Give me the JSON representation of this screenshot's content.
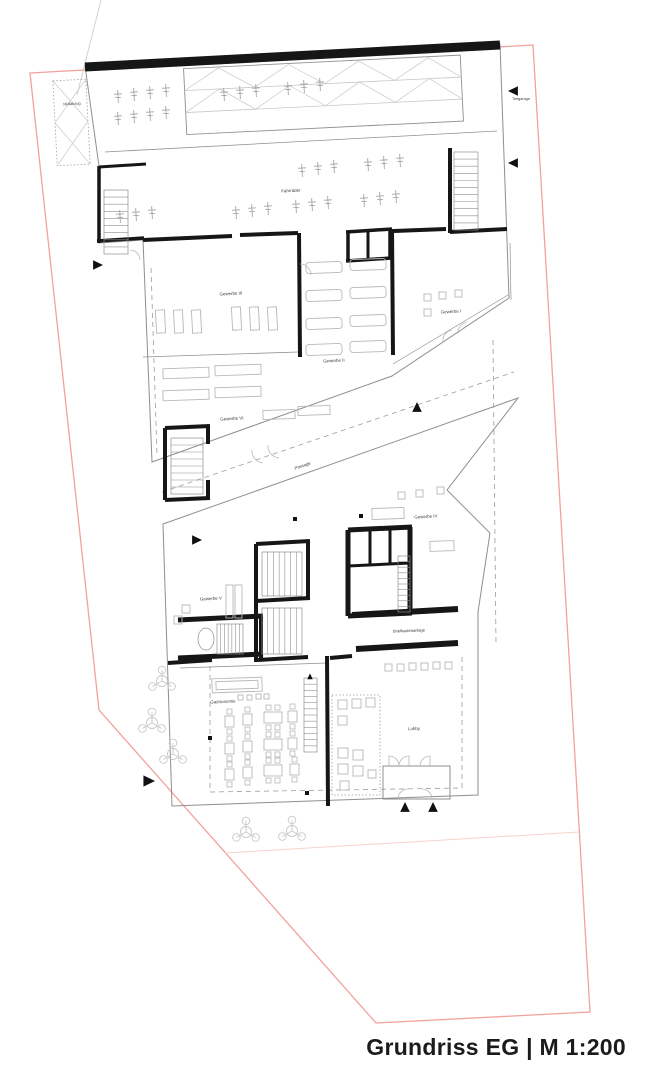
{
  "title": {
    "text": "Grundriss EG | M 1:200"
  },
  "colors": {
    "wall": "#161616",
    "thin": "#8f8f8f",
    "furniture": "#b8b8b8",
    "light": "#c8c8c8",
    "dash": "#9c9c9c",
    "label": "#3a3a3a",
    "boundary_red": "#f2a29b",
    "faint_red": "#f7d2ce",
    "construction": "#d2d2d2",
    "arrow": "#111111"
  },
  "site": {
    "boundary_points": "30,73 533,45 590,1012 376,1023 99,710",
    "faint_line": [
      225,
      853,
      579,
      832
    ],
    "construction_line": [
      101,
      0,
      77,
      95
    ]
  },
  "rooms": [
    {
      "id": "muellabzug",
      "label": "Müllabzug",
      "x": 72,
      "y": 105,
      "size": 3.8,
      "rot": -3
    },
    {
      "id": "tiefgarage",
      "label": "Tiefgarage",
      "x": 521,
      "y": 100,
      "size": 3.8,
      "rot": 0
    },
    {
      "id": "fahrraeder",
      "label": "Fahrräder",
      "x": 291,
      "y": 192,
      "size": 4.4,
      "rot": -3
    },
    {
      "id": "gewerbe-iii",
      "label": "Gewerbe III",
      "x": 231,
      "y": 295,
      "size": 4.4,
      "rot": -3
    },
    {
      "id": "gewerbe-i",
      "label": "Gewerbe I",
      "x": 451,
      "y": 313,
      "size": 4.4,
      "rot": -3
    },
    {
      "id": "gewerbe-ii",
      "label": "Gewerbe II",
      "x": 334,
      "y": 362,
      "size": 4.4,
      "rot": -3
    },
    {
      "id": "gewerbe-vi",
      "label": "Gewerbe VI",
      "x": 232,
      "y": 420,
      "size": 4.4,
      "rot": -3
    },
    {
      "id": "passage",
      "label": "Passage",
      "x": 303,
      "y": 467,
      "size": 4.3,
      "rot": -19
    },
    {
      "id": "gewerbe-iv",
      "label": "Gewerbe IV",
      "x": 426,
      "y": 518,
      "size": 4.4,
      "rot": -3
    },
    {
      "id": "gewerbe-v",
      "label": "Gewerbe V",
      "x": 211,
      "y": 600,
      "size": 4.4,
      "rot": -3
    },
    {
      "id": "briefkastenanlage",
      "label": "Briefkastenanlage",
      "x": 409,
      "y": 632,
      "size": 4.0,
      "rot": -2
    },
    {
      "id": "gastronomie",
      "label": "Gastronomie",
      "x": 223,
      "y": 703,
      "size": 4.4,
      "rot": -2
    },
    {
      "id": "lobby",
      "label": "Lobby",
      "x": 414,
      "y": 730,
      "size": 4.4,
      "rot": -2
    }
  ],
  "plan": {
    "outlines": [
      "85,66 500,44 507,240 509,298 392,376 152,462 143,240 99,243 99,166",
      "163,524 518,398 447,490 490,533 478,612 478,795 172,806",
      "383,766 450,766 450,799 383,799"
    ],
    "facade_inner_lines": [
      [
        508,
        295,
        393,
        364
      ],
      [
        511,
        300,
        510,
        243
      ]
    ],
    "walls": [
      [
        85,
        67,
        500,
        45,
        9
      ],
      [
        99,
        166,
        99,
        243,
        3.5
      ],
      [
        97,
        241,
        144,
        238,
        3.5
      ],
      [
        99,
        167,
        146,
        164,
        3
      ],
      [
        143,
        240,
        232,
        236,
        4
      ],
      [
        240,
        235,
        298,
        233,
        4
      ],
      [
        299,
        233,
        300,
        357,
        4
      ],
      [
        392,
        229,
        393,
        355,
        4
      ],
      [
        346,
        232,
        392,
        229,
        3.5
      ],
      [
        346,
        261,
        392,
        258,
        3.5
      ],
      [
        348,
        231,
        348,
        260,
        3.5
      ],
      [
        390,
        230,
        390,
        259,
        3.5
      ],
      [
        368,
        231,
        368,
        259,
        3
      ],
      [
        394,
        231,
        446,
        229,
        4
      ],
      [
        450,
        232,
        507,
        229,
        4
      ],
      [
        450,
        148,
        450,
        233,
        4
      ],
      [
        165,
        428,
        210,
        426,
        4
      ],
      [
        165,
        428,
        165,
        500,
        4
      ],
      [
        165,
        500,
        210,
        498,
        4
      ],
      [
        208,
        426,
        208,
        444,
        4
      ],
      [
        208,
        480,
        208,
        499,
        4
      ],
      [
        256,
        544,
        310,
        541,
        4
      ],
      [
        256,
        544,
        256,
        662,
        4
      ],
      [
        308,
        541,
        308,
        600,
        4
      ],
      [
        256,
        601,
        310,
        598,
        4
      ],
      [
        258,
        660,
        308,
        657,
        4
      ],
      [
        178,
        620,
        263,
        616,
        5
      ],
      [
        178,
        658,
        263,
        654,
        5
      ],
      [
        261,
        616,
        261,
        658,
        4
      ],
      [
        348,
        530,
        412,
        527,
        5
      ],
      [
        348,
        530,
        348,
        616,
        5
      ],
      [
        410,
        527,
        410,
        614,
        5
      ],
      [
        348,
        616,
        412,
        613,
        5
      ],
      [
        370,
        530,
        370,
        565,
        3
      ],
      [
        390,
        528,
        390,
        565,
        3
      ],
      [
        348,
        566,
        410,
        563,
        3
      ],
      [
        327,
        656,
        328,
        806,
        4
      ],
      [
        330,
        658,
        352,
        656,
        4
      ],
      [
        168,
        663,
        212,
        660,
        4
      ],
      [
        352,
        615,
        458,
        609,
        6
      ],
      [
        356,
        649,
        458,
        643,
        6
      ]
    ],
    "thin_lines": [
      [
        105,
        152,
        497,
        131
      ],
      [
        143,
        357,
        298,
        352
      ],
      [
        180,
        668,
        327,
        663
      ]
    ],
    "dashed_lines": [
      [
        493,
        340,
        496,
        645
      ],
      [
        151,
        268,
        157,
        455
      ],
      [
        162,
        492,
        514,
        372
      ],
      [
        210,
        666,
        210,
        792
      ],
      [
        210,
        792,
        462,
        788
      ],
      [
        462,
        788,
        462,
        656
      ]
    ],
    "ramp": {
      "rot": [
        -2.8,
        320,
        95
      ],
      "rect": [
        185,
        62,
        277,
        66
      ],
      "lanes": [
        [
          185,
          84,
          462,
          84
        ],
        [
          185,
          106,
          462,
          106
        ]
      ],
      "zigzag": [
        "185,84 220,63 255,84 290,63 325,84 360,63 395,84 430,63 462,84",
        "185,106 220,84 255,106 290,84 325,106 360,84 395,106 430,84 462,106"
      ]
    },
    "muell_strip": {
      "rot": [
        -3,
        71,
        122
      ],
      "rect": [
        55,
        80,
        33,
        85
      ],
      "x_lines": [
        [
          55,
          80,
          88,
          122
        ],
        [
          88,
          80,
          55,
          122
        ],
        [
          55,
          122,
          88,
          165
        ],
        [
          88,
          122,
          55,
          165
        ]
      ]
    },
    "lobby_dotted_rect": [
      332,
      695,
      48,
      100
    ],
    "stairs": [
      {
        "x": 104,
        "y": 190,
        "w": 24,
        "h": 64,
        "n": 9,
        "flight": "v"
      },
      {
        "x": 454,
        "y": 152,
        "w": 24,
        "h": 78,
        "n": 11,
        "flight": "v"
      },
      {
        "x": 171,
        "y": 438,
        "w": 32,
        "h": 56,
        "n": 8,
        "flight": "v"
      },
      {
        "x": 262,
        "y": 552,
        "w": 40,
        "h": 44,
        "n": 7,
        "flight": "h"
      },
      {
        "x": 262,
        "y": 608,
        "w": 40,
        "h": 46,
        "n": 7,
        "flight": "h"
      },
      {
        "x": 217,
        "y": 624,
        "w": 26,
        "h": 30,
        "n": 7,
        "flight": "h",
        "ellipse": [
          206,
          639,
          8,
          11
        ]
      },
      {
        "x": 398,
        "y": 556,
        "w": 12,
        "h": 56,
        "n": 10,
        "flight": "v"
      },
      {
        "x": 304,
        "y": 678,
        "w": 13,
        "h": 74,
        "n": 12,
        "flight": "v"
      }
    ],
    "furniture_rects": [
      [
        156,
        310,
        9,
        23,
        0,
        -3
      ],
      [
        174,
        310,
        9,
        23,
        0,
        -3
      ],
      [
        192,
        310,
        9,
        23,
        0,
        -3
      ],
      [
        232,
        307,
        9,
        23,
        0,
        -3
      ],
      [
        250,
        307,
        9,
        23,
        0,
        -3
      ],
      [
        268,
        307,
        9,
        23,
        0,
        -3
      ],
      [
        306,
        262,
        36,
        11,
        3,
        -2
      ],
      [
        350,
        259,
        36,
        11,
        3,
        -2
      ],
      [
        306,
        290,
        36,
        11,
        3,
        -2
      ],
      [
        350,
        287,
        36,
        11,
        3,
        -2
      ],
      [
        306,
        318,
        36,
        11,
        3,
        -2
      ],
      [
        350,
        315,
        36,
        11,
        3,
        -2
      ],
      [
        306,
        344,
        36,
        11,
        3,
        -2
      ],
      [
        350,
        341,
        36,
        11,
        3,
        -2
      ],
      [
        163,
        368,
        46,
        10,
        0,
        -2
      ],
      [
        215,
        365,
        46,
        10,
        0,
        -2
      ],
      [
        163,
        390,
        46,
        10,
        0,
        -2
      ],
      [
        215,
        387,
        46,
        10,
        0,
        -2
      ],
      [
        263,
        410,
        32,
        9,
        0,
        -2
      ],
      [
        298,
        406,
        32,
        9,
        0,
        -2
      ],
      [
        372,
        508,
        32,
        11,
        0,
        -2
      ],
      [
        430,
        541,
        24,
        10,
        0,
        -2
      ],
      [
        226,
        585,
        7,
        33,
        0,
        0
      ],
      [
        235,
        585,
        7,
        33,
        0,
        0
      ],
      [
        212,
        678,
        50,
        14,
        0,
        -2
      ],
      [
        216,
        681,
        42,
        8,
        0,
        -2
      ]
    ],
    "squares": [
      [
        424,
        294,
        7
      ],
      [
        439,
        292,
        7
      ],
      [
        455,
        290,
        7
      ],
      [
        424,
        309,
        7
      ],
      [
        398,
        492,
        7
      ],
      [
        416,
        490,
        7
      ],
      [
        437,
        487,
        7
      ],
      [
        182,
        605,
        8
      ],
      [
        174,
        616,
        8
      ],
      [
        385,
        664,
        7
      ],
      [
        397,
        664,
        7
      ],
      [
        409,
        663,
        7
      ],
      [
        421,
        663,
        7
      ],
      [
        433,
        662,
        7
      ],
      [
        445,
        662,
        7
      ],
      [
        238,
        695,
        5
      ],
      [
        247,
        695,
        5
      ],
      [
        256,
        694,
        5
      ],
      [
        264,
        694,
        5
      ],
      [
        338,
        700,
        9
      ],
      [
        352,
        699,
        9
      ],
      [
        366,
        698,
        9
      ],
      [
        338,
        716,
        9
      ],
      [
        338,
        748,
        10
      ],
      [
        353,
        750,
        10
      ],
      [
        338,
        764,
        10
      ],
      [
        353,
        766,
        10
      ],
      [
        340,
        781,
        9
      ],
      [
        368,
        770,
        8
      ]
    ],
    "tables": [
      {
        "x": 225,
        "y": 716,
        "wide": false
      },
      {
        "x": 243,
        "y": 714,
        "wide": false
      },
      {
        "x": 264,
        "y": 712,
        "wide": true
      },
      {
        "x": 288,
        "y": 711,
        "wide": false
      },
      {
        "x": 225,
        "y": 743,
        "wide": false
      },
      {
        "x": 243,
        "y": 741,
        "wide": false
      },
      {
        "x": 264,
        "y": 739,
        "wide": true
      },
      {
        "x": 288,
        "y": 738,
        "wide": false
      },
      {
        "x": 225,
        "y": 769,
        "wide": false
      },
      {
        "x": 243,
        "y": 767,
        "wide": false
      },
      {
        "x": 264,
        "y": 765,
        "wide": true
      },
      {
        "x": 290,
        "y": 764,
        "wide": false
      }
    ],
    "bikes": [
      [
        118,
        96
      ],
      [
        134,
        94
      ],
      [
        150,
        92
      ],
      [
        166,
        90
      ],
      [
        118,
        118
      ],
      [
        134,
        116
      ],
      [
        150,
        114
      ],
      [
        166,
        112
      ],
      [
        224,
        94
      ],
      [
        240,
        92
      ],
      [
        256,
        90
      ],
      [
        288,
        88
      ],
      [
        304,
        86
      ],
      [
        320,
        84
      ],
      [
        302,
        170
      ],
      [
        318,
        168
      ],
      [
        334,
        166
      ],
      [
        368,
        164
      ],
      [
        384,
        162
      ],
      [
        400,
        160
      ],
      [
        236,
        212
      ],
      [
        252,
        210
      ],
      [
        268,
        208
      ],
      [
        296,
        206
      ],
      [
        312,
        204
      ],
      [
        328,
        202
      ],
      [
        364,
        200
      ],
      [
        380,
        198
      ],
      [
        396,
        196
      ],
      [
        120,
        216
      ],
      [
        136,
        214
      ],
      [
        152,
        212
      ]
    ],
    "door_arcs": [
      "M389,766 l0,-10 a10,10 0 0 1 10,10",
      "M409,766 l0,-10 a10,10 0 0 0 -10,10",
      "M430,766 l0,-10 a10,10 0 0 0 -10,10",
      "M398,799 a10,10 0 0 1 10,-10",
      "M432,799 a10,10 0 0 0 -10,-10",
      "M252,450 a12,12 0 0 0 11,13",
      "M268,445 a12,12 0 0 0 11,13",
      "M443,342 a11,11 0 0 1 9,-12",
      "M458,334 a11,11 0 0 1 9,-12",
      "M130,250 a10,10 0 0 1 10,10",
      "M300,264 a11,11 0 0 1 11,11"
    ],
    "trees": [
      [
        162,
        681
      ],
      [
        152,
        723
      ],
      [
        173,
        754
      ],
      [
        246,
        832
      ],
      [
        292,
        831
      ]
    ],
    "arrows": [
      {
        "x": 514,
        "y": 91,
        "dir": "left",
        "s": 6
      },
      {
        "x": 514,
        "y": 163,
        "dir": "left",
        "s": 6
      },
      {
        "x": 97,
        "y": 265,
        "dir": "right",
        "s": 6
      },
      {
        "x": 196,
        "y": 540,
        "dir": "right",
        "s": 6
      },
      {
        "x": 148,
        "y": 781,
        "dir": "right",
        "s": 7
      },
      {
        "x": 417,
        "y": 408,
        "dir": "up",
        "s": 6
      },
      {
        "x": 405,
        "y": 808,
        "dir": "up",
        "s": 6
      },
      {
        "x": 433,
        "y": 808,
        "dir": "up",
        "s": 6
      },
      {
        "x": 310,
        "y": 677,
        "dir": "up",
        "s": 3.5
      }
    ],
    "dots": [
      [
        210,
        738
      ],
      [
        307,
        793
      ],
      [
        295,
        519
      ],
      [
        361,
        516
      ]
    ]
  }
}
